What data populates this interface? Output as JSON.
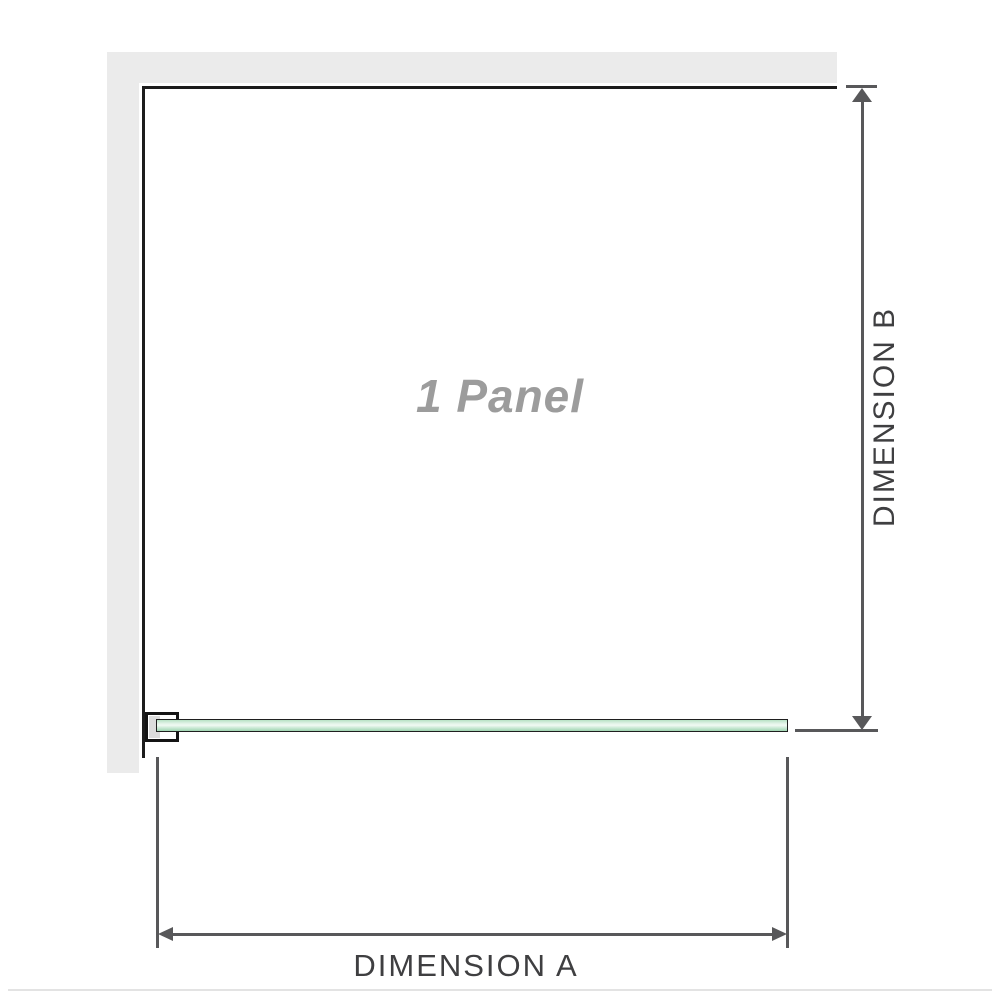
{
  "diagram": {
    "type": "shower-screen-panel-dimension-diagram",
    "panel_label": "1 Panel",
    "dimension_a": {
      "label": "DIMENSION A",
      "orientation": "horizontal",
      "measures": "panel width"
    },
    "dimension_b": {
      "label": "DIMENSION B",
      "orientation": "vertical",
      "measures": "panel height"
    },
    "colors": {
      "wall": "#ebebeb",
      "outline": "#1c1c1c",
      "dimension_lines": "#58585a",
      "label_text": "#3f3f41",
      "panel_label_text": "#9c9c9c",
      "glass_green": "#a9dcba",
      "glass_highlight": "#f1faf3",
      "bracket_inner": "#dcdcdc",
      "baseline": "#e3e3e3"
    }
  }
}
